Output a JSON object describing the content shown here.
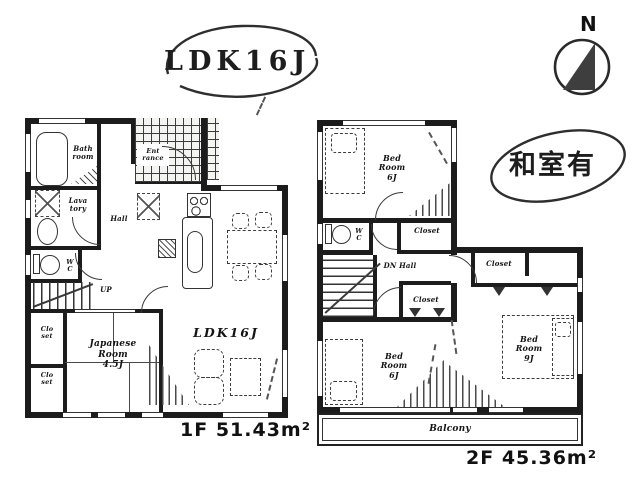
{
  "canvas": {
    "bg": "#ffffff",
    "ink": "#222222"
  },
  "badges": {
    "ldk": "LDK16J",
    "washitsu": "和室有",
    "north": "N"
  },
  "floor1": {
    "area_label": "1F 51.43m²",
    "bath": "Bath\nroom",
    "lavatory": "Lava\ntory",
    "wc": "W\nC",
    "hall": "Hall",
    "entrance": "Ent\nrance",
    "up": "UP",
    "closet_upper": "Clo\nset",
    "closet_lower": "Clo\nset",
    "japanese_room": "Japanese\nRoom\n4.5J",
    "ldk": "LDK16J"
  },
  "floor2": {
    "area_label": "2F 45.36m²",
    "bedroom_nw": "Bed\nRoom\n6J",
    "wc": "W\nC",
    "closet_a": "Closet",
    "dn_hall": "DN Hall",
    "closet_b": "Closet",
    "closet_c": "Closet",
    "bedroom_sw": "Bed\nRoom\n6J",
    "bedroom_e": "Bed\nRoom\n9J",
    "balcony": "Balcony"
  }
}
